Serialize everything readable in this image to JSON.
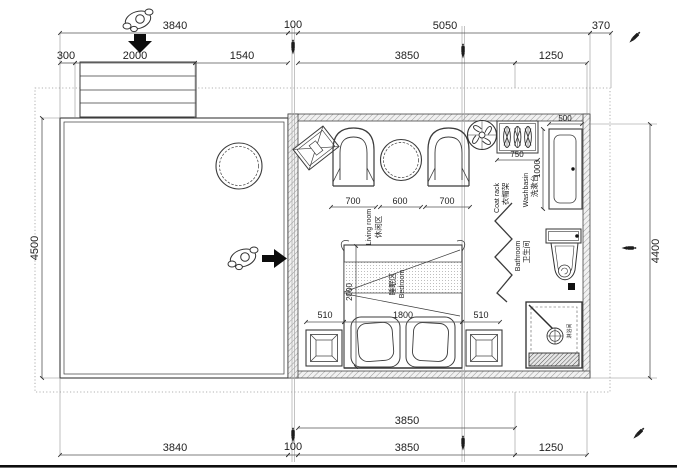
{
  "dims": {
    "top1": {
      "a": "3840",
      "b": "100",
      "c": "5050",
      "d": "370"
    },
    "top2": {
      "a": "300",
      "b": "2000",
      "c": "1540",
      "d": "3850",
      "e": "1250"
    },
    "bottom1": {
      "a": "3850"
    },
    "bottom2": {
      "a": "3840",
      "b": "100",
      "c": "3850",
      "d": "1250"
    },
    "left": "4500",
    "right": "4400",
    "living": {
      "a": "700",
      "b": "600",
      "c": "700"
    },
    "bed": {
      "depth": "2000",
      "width": "1800",
      "left": "510",
      "right": "510"
    },
    "washbasin": {
      "width": "500",
      "depth": "1000"
    },
    "coat_rack": "750"
  },
  "rooms": {
    "living": {
      "zh": "休闲区",
      "en": "Living room"
    },
    "bedroom": {
      "zh": "睡眠区",
      "en": "Bedroom"
    },
    "bathroom": {
      "zh": "卫生间",
      "en": "Bathroom"
    },
    "washbasin": {
      "zh": "洗漱台",
      "en": "Washbasin"
    },
    "coat_rack": {
      "zh": "衣帽架",
      "en": "Coat rack"
    },
    "shower": {
      "zh": "淋浴间"
    }
  },
  "icons": {
    "person": "person-top-view",
    "pen": "pen-marker",
    "arrow_down": "entry-direction-down",
    "arrow_right": "entry-direction-right"
  },
  "colors": {
    "line": "#3b3b3b",
    "dim_text": "#1e1e1e",
    "wall_hatch": "#9a9a9a",
    "black": "#111111"
  }
}
